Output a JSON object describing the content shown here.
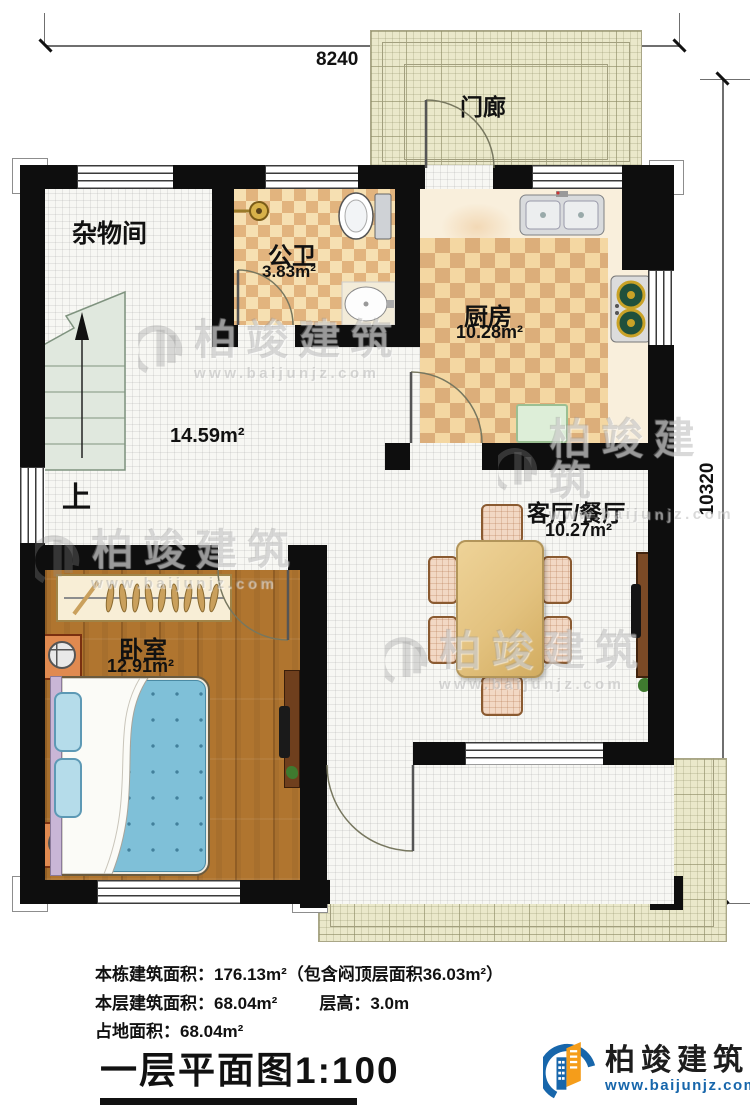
{
  "dimensions": {
    "top": "8240",
    "right": "10320"
  },
  "rooms": {
    "porch_top": {
      "name": "门廊"
    },
    "storage": {
      "name": "杂物间"
    },
    "bathroom": {
      "name": "公卫",
      "area": "3.83m²"
    },
    "kitchen": {
      "name": "厨房",
      "area": "10.28m²"
    },
    "hall": {
      "area": "14.59m²",
      "stair_label": "上"
    },
    "living": {
      "name": "客厅/餐厅",
      "area": "10.27m²"
    },
    "bedroom": {
      "name": "卧室",
      "area": "12.91m²"
    },
    "porch_bottom": {
      "name": "门廊"
    }
  },
  "watermark": {
    "brand": "柏竣建筑",
    "url": "www.baijunjz.com"
  },
  "footer": {
    "line1": "本栋建筑面积：176.13m²（包含闷顶层面积36.03m²）",
    "line2_left": "本层建筑面积：68.04m²",
    "line2_right": "层高：3.0m",
    "line3": "占地面积：68.04m²",
    "title": "一层平面图1:100"
  },
  "logo": {
    "brand": "柏竣建筑",
    "url": "www.baijunjz.com"
  },
  "colors": {
    "wall": "#0e0e0e",
    "porch_fill": "#eae8ca",
    "tile_fill": "#f7f7f3",
    "wood_fill": "#b0752f",
    "checker_dark": "#e2b47e",
    "checker_light": "#f6e0b2",
    "stair_fill": "#e0e8de",
    "bed_blue": "#7fc0d8",
    "logo_blue": "#1766ab",
    "logo_orange": "#f59d1a"
  }
}
